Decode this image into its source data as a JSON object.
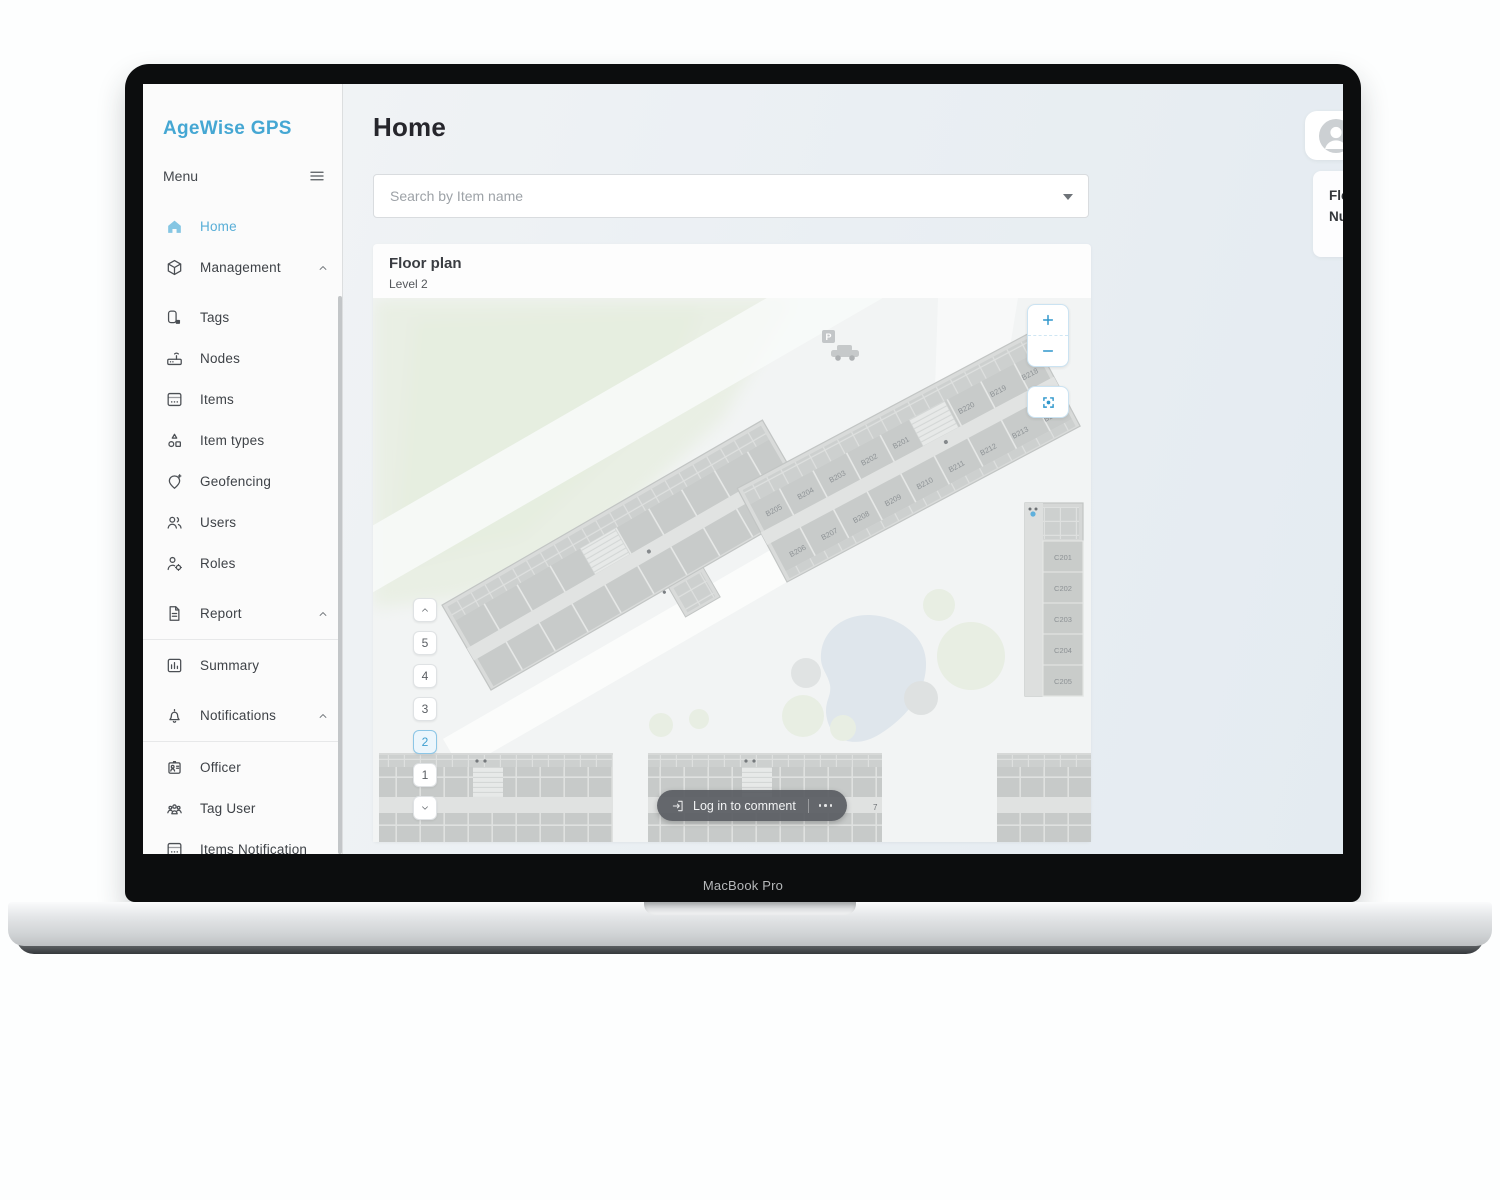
{
  "app": {
    "logo": "AgeWise GPS",
    "device_label": "MacBook Pro"
  },
  "colors": {
    "accent": "#45a7d3",
    "active_level": "#3f9fd0",
    "pill": "#55595e"
  },
  "sidebar": {
    "menu_label": "Menu",
    "items": [
      {
        "label": "Home",
        "icon": "home-icon",
        "active": true
      },
      {
        "label": "Management",
        "icon": "package-icon",
        "expandable": true
      },
      {
        "label": "Tags",
        "icon": "tag-icon",
        "gap": true
      },
      {
        "label": "Nodes",
        "icon": "router-icon"
      },
      {
        "label": "Items",
        "icon": "items-icon"
      },
      {
        "label": "Item types",
        "icon": "item-types-icon"
      },
      {
        "label": "Geofencing",
        "icon": "geofence-icon"
      },
      {
        "label": "Users",
        "icon": "users-icon"
      },
      {
        "label": "Roles",
        "icon": "roles-icon"
      },
      {
        "label": "Report",
        "icon": "report-icon",
        "expandable": true,
        "gap": true,
        "divider_after": true
      },
      {
        "label": "Summary",
        "icon": "summary-icon"
      },
      {
        "label": "Notifications",
        "icon": "bell-icon",
        "expandable": true,
        "gap": true,
        "divider_after": true
      },
      {
        "label": "Officer",
        "icon": "badge-icon"
      },
      {
        "label": "Tag User",
        "icon": "tag-user-icon"
      },
      {
        "label": "Items Notification",
        "icon": "items-notification-icon"
      }
    ]
  },
  "header": {
    "title": "Home"
  },
  "search": {
    "placeholder": "Search by Item name"
  },
  "user": {
    "name": "himasara98",
    "role": "admin"
  },
  "info": {
    "floor_label": "Floor level:",
    "floor_value": "Level 2",
    "tags_label": "Number of tags:",
    "tags_value": "0 tags"
  },
  "floorplan": {
    "title": "Floor plan",
    "subtitle": "Level 2",
    "levels": [
      "5",
      "4",
      "3",
      "2",
      "1"
    ],
    "active_level": "2",
    "comment_button": "Log in to comment",
    "parking_label": "P",
    "small_label": "7",
    "rooms": {
      "b_top": [
        "B205",
        "B204",
        "B203",
        "B202",
        "B201"
      ],
      "b_top_right": [
        "B220",
        "B219",
        "B218"
      ],
      "b_bottom": [
        "B206",
        "B207",
        "B208",
        "B209",
        "B210",
        "B211",
        "B212",
        "B213",
        "B214"
      ],
      "c": [
        "C201",
        "C202",
        "C203",
        "C204",
        "C205"
      ]
    }
  }
}
